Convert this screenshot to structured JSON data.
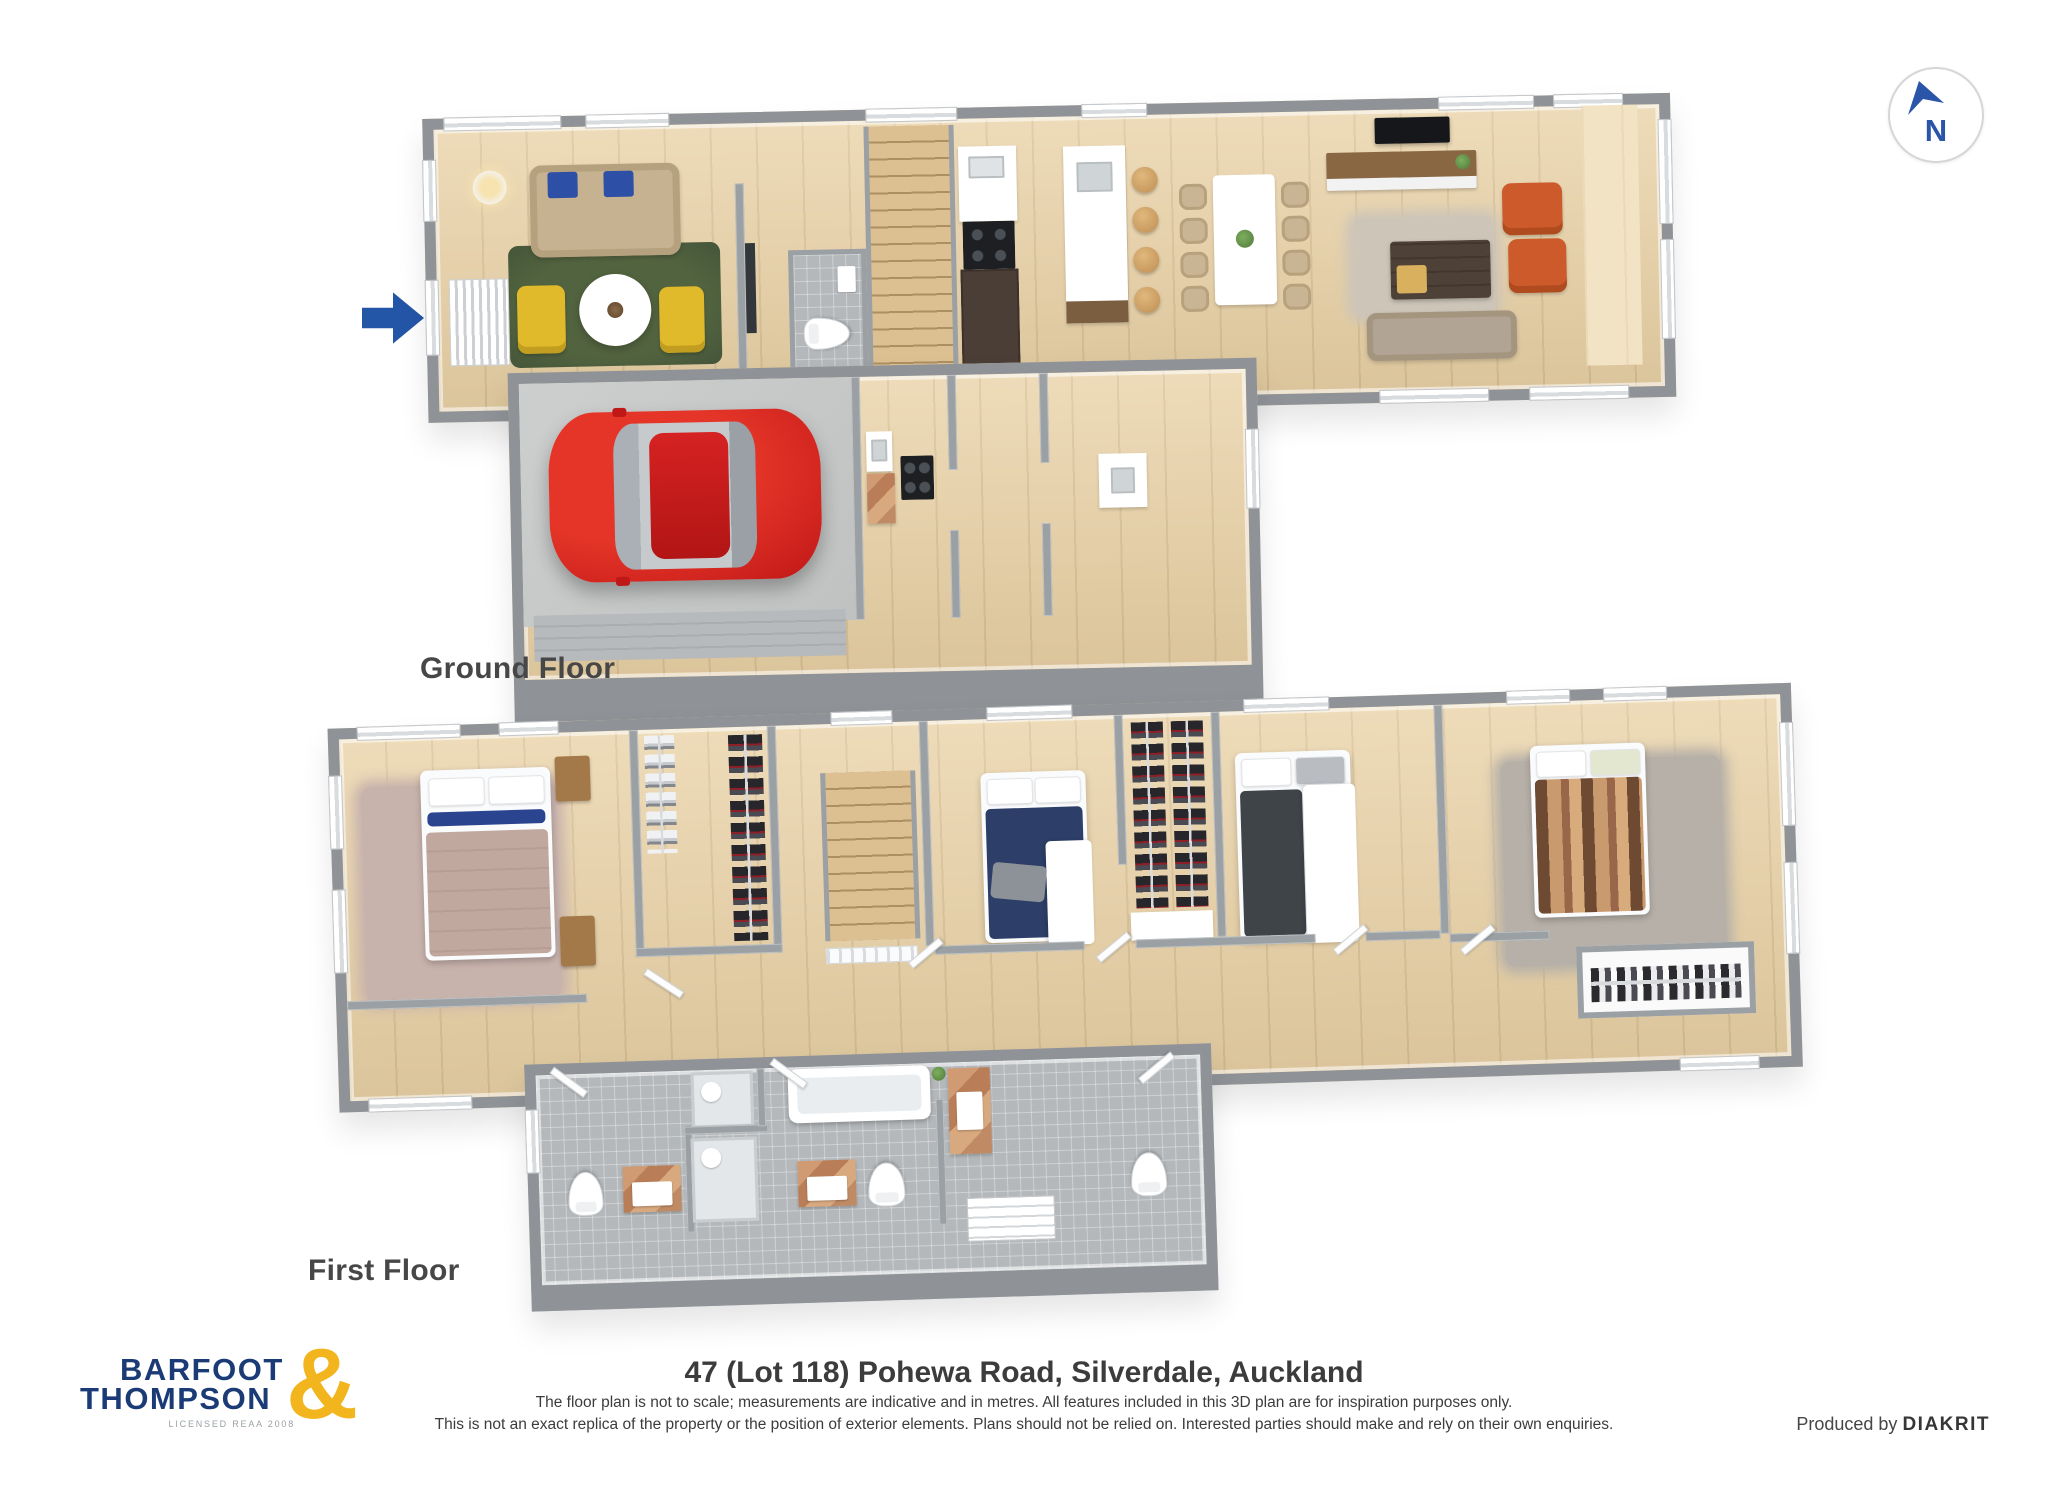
{
  "document": {
    "type": "3d-floor-plan-sheet"
  },
  "compass": {
    "label": "N"
  },
  "entry": {
    "symbol": "right-arrow"
  },
  "floors": {
    "ground": {
      "label": "Ground Floor",
      "rooms": [
        "entry",
        "lounge",
        "powder-room",
        "stairs",
        "kitchen",
        "island-bench",
        "dining",
        "family-room",
        "garage",
        "scullery",
        "laundry"
      ]
    },
    "first": {
      "label": "First Floor",
      "rooms": [
        "master-bedroom",
        "walk-in-wardrobe",
        "landing",
        "bedroom-2",
        "wardrobes",
        "bedroom-3",
        "bedroom-4",
        "linen-closet",
        "ensuite",
        "bathroom",
        "toilet"
      ]
    }
  },
  "footer": {
    "brand": {
      "line1": "BARFOOT",
      "line2": "THOMPSON",
      "ampersand": "&",
      "tagline": "LICENSED REAA 2008"
    },
    "address": "47 (Lot 118) Pohewa Road, Silverdale, Auckland",
    "disclaimer1": "The floor plan is not to scale; measurements are indicative and in metres. All features included in this 3D plan are for inspiration purposes only.",
    "disclaimer2": "This is not an exact replica of the property or the position of exterior elements. Plans should not be relied on. Interested parties should make and rely on their own enquiries.",
    "produced_by": "Produced by",
    "producer": "DIAKRIT"
  },
  "palette": {
    "wall": "#8f9296",
    "wood": "#e9d1a5",
    "tile": "#b4b8bb",
    "concrete": "#c9cbcb",
    "brand_navy": "#1b3b76",
    "brand_gold": "#f2b51e",
    "compass_blue": "#2a55a8",
    "car_red": "#cc1f1f",
    "rug_green": "#4a5c42",
    "chair_yellow": "#e0ba2a",
    "chair_orange": "#cd5a2b",
    "pillow_navy": "#2e4fa6",
    "bed_navy": "#2d3f68",
    "bed_mauve": "#c1a89e",
    "bed_charcoal": "#3f4449",
    "vanity_copper": "#c08a64"
  }
}
